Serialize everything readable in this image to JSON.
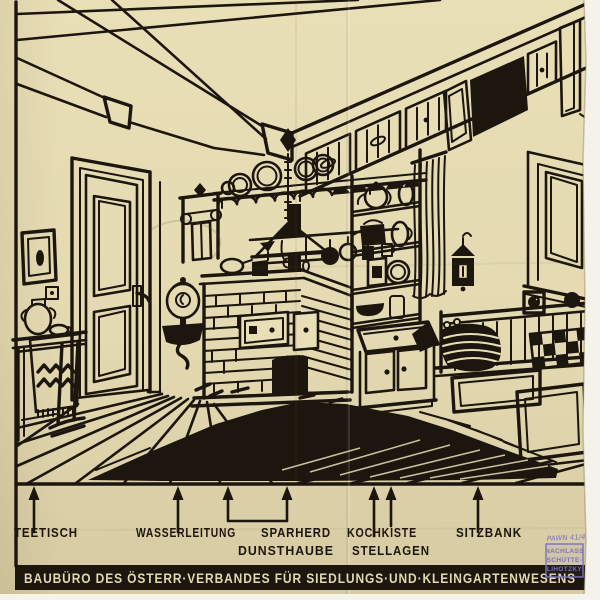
{
  "labels": {
    "teetisch": "TEETISCH",
    "wasserleitung": "WASSERLEITUNG",
    "sparherd": "SPARHERD",
    "dunsthaube": "DUNSTHAUBE",
    "kochkiste": "KOCHKISTE",
    "stellagen": "STELLAGEN",
    "sitzbank": "SITZBANK"
  },
  "banner": {
    "text": "BAUBÜRO DES ÖSTERR·VERBANDES FÜR SIEDLUNGS·UND·KLEINGARTENWESENS"
  },
  "stamp": {
    "handwritten": "PAWN 41/4",
    "line1": "NACHLASS",
    "line2": "SCHÜTTE-",
    "line3": "LIHOTZKY"
  },
  "colors": {
    "paper": "#e9dfb7",
    "ink": "#1c160e",
    "banner_text": "#e3d9ae",
    "stamp_blue": "#7a72bd",
    "margin_white": "#f4f2ea"
  }
}
